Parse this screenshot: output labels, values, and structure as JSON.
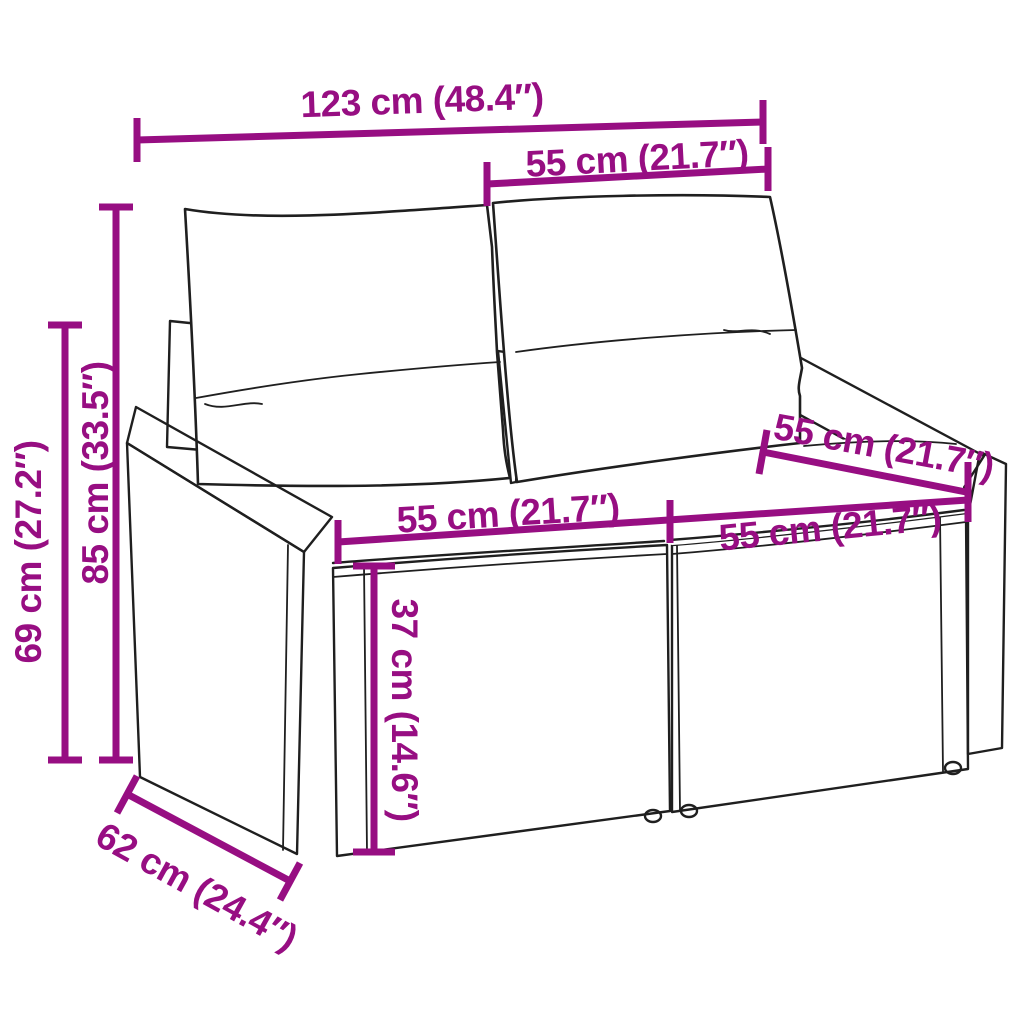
{
  "meta": {
    "type": "product dimension diagram",
    "subject": "poly rattan 2-seater garden sofa with back and seat cushions"
  },
  "colors": {
    "dimension_accent": "#970e82",
    "drawing_line": "#1f1f1f",
    "background": "#ffffff"
  },
  "dimensions": {
    "overall_width": {
      "label": "123 cm (48.4″)"
    },
    "backrest_cushion_width": {
      "label": "55 cm (21.7″)"
    },
    "overall_height": {
      "label": "85 cm (33.5″)"
    },
    "armrest_height": {
      "label": "69 cm (27.2″)"
    },
    "left_seat_width": {
      "label": "55 cm (21.7″)"
    },
    "right_seat_width": {
      "label": "55 cm (21.7″)"
    },
    "seat_depth": {
      "label": "55 cm (21.7″)"
    },
    "seat_height": {
      "label": "37 cm (14.6″)"
    },
    "overall_depth": {
      "label": "62 cm (24.4″)"
    }
  }
}
